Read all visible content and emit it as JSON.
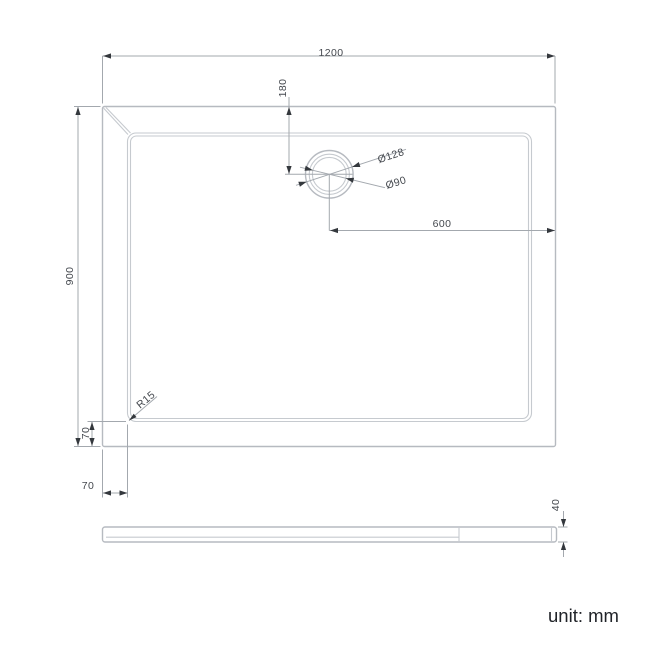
{
  "drawing": {
    "title": "shower-tray-technical-drawing",
    "unit_label": "unit: mm",
    "dimensions": {
      "overall_width": "1200",
      "overall_depth": "900",
      "drain_offset_from_top": "180",
      "drain_outer_diameter": "Ø128",
      "drain_inner_diameter": "Ø90",
      "drain_center_from_right_edge": "600",
      "rim_width_left": "70",
      "rim_width_bottom": "70",
      "inner_corner_radius": "R15",
      "tray_height": "40"
    },
    "colors": {
      "shape_line": "#b6bac0",
      "dimension_line": "#a3a8ae",
      "arrow": "#34383d",
      "text": "#44484e"
    }
  }
}
